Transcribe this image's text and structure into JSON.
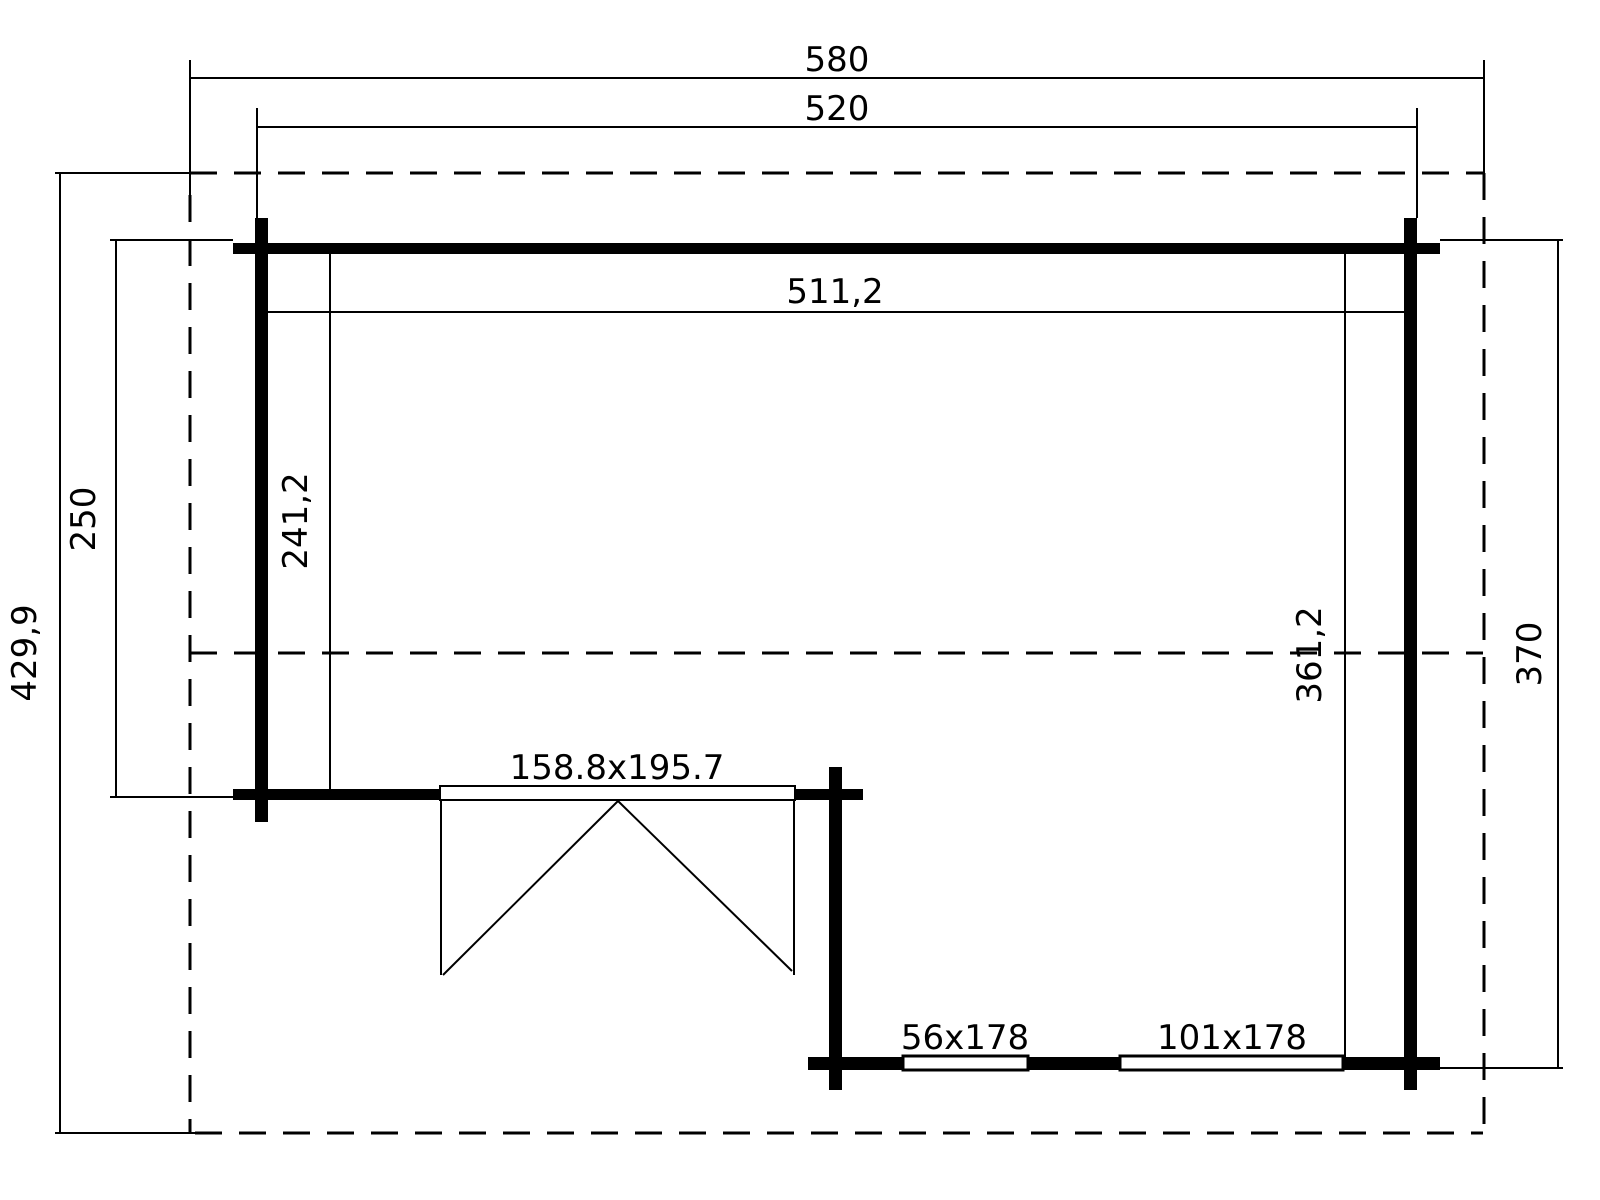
{
  "diagram": {
    "type": "floor-plan",
    "canvas": {
      "width": 1600,
      "height": 1200,
      "background": "#ffffff",
      "line_color": "#000000"
    },
    "labels": [
      {
        "name": "dim-label-roof-width",
        "text": "580",
        "x": 837,
        "y": 71,
        "rotate": 0
      },
      {
        "name": "dim-label-outer-width",
        "text": "520",
        "x": 837,
        "y": 120,
        "rotate": 0
      },
      {
        "name": "dim-label-inner-width",
        "text": "511,2",
        "x": 835,
        "y": 303,
        "rotate": 0
      },
      {
        "name": "dim-label-roof-depth",
        "text": "429,9",
        "x": 36,
        "y": 653,
        "rotate": -90
      },
      {
        "name": "dim-label-left-wall-depth",
        "text": "250",
        "x": 95,
        "y": 519,
        "rotate": -90
      },
      {
        "name": "dim-label-inner-depth-left",
        "text": "241,2",
        "x": 307,
        "y": 521,
        "rotate": -90
      },
      {
        "name": "dim-label-inner-depth-right",
        "text": "361,2",
        "x": 1321,
        "y": 655,
        "rotate": -90
      },
      {
        "name": "dim-label-right-wall-depth",
        "text": "370",
        "x": 1541,
        "y": 654,
        "rotate": -90
      },
      {
        "name": "door-size-label",
        "text": "158.8x195.7",
        "x": 617,
        "y": 779,
        "rotate": 0
      },
      {
        "name": "window-small-label",
        "text": "56x178",
        "x": 965,
        "y": 1049,
        "rotate": 0
      },
      {
        "name": "window-large-label",
        "text": "101x178",
        "x": 1232,
        "y": 1049,
        "rotate": 0
      }
    ],
    "walls": [
      {
        "name": "wall-top",
        "x": 233,
        "y": 243,
        "w": 1207,
        "h": 11
      },
      {
        "name": "wall-left",
        "x": 255,
        "y": 218,
        "w": 13,
        "h": 604
      },
      {
        "name": "wall-right",
        "x": 1404,
        "y": 218,
        "w": 13,
        "h": 872
      },
      {
        "name": "wall-door-left",
        "x": 233,
        "y": 789,
        "w": 210,
        "h": 11
      },
      {
        "name": "wall-door-right",
        "x": 790,
        "y": 789,
        "w": 73,
        "h": 11
      },
      {
        "name": "wall-mid-post",
        "x": 829,
        "y": 767,
        "w": 13,
        "h": 323
      },
      {
        "name": "wall-bottom-left-stub",
        "x": 808,
        "y": 1057,
        "w": 97,
        "h": 13
      },
      {
        "name": "wall-bottom-mid",
        "x": 1026,
        "y": 1057,
        "w": 96,
        "h": 13
      },
      {
        "name": "wall-bottom-right",
        "x": 1341,
        "y": 1057,
        "w": 99,
        "h": 13
      }
    ],
    "openings": [
      {
        "name": "door-frame",
        "x": 440,
        "y": 786,
        "w": 355,
        "h": 14,
        "stroke_w": 2
      },
      {
        "name": "window-small",
        "x": 903,
        "y": 1056,
        "w": 125,
        "h": 14,
        "stroke_w": 3
      },
      {
        "name": "window-large",
        "x": 1120,
        "y": 1056,
        "w": 223,
        "h": 14,
        "stroke_w": 3
      }
    ],
    "thin_lines": [
      {
        "name": "dim-line-580",
        "x1": 190,
        "y1": 78,
        "x2": 1485,
        "y2": 78
      },
      {
        "name": "dim-line-520",
        "x1": 257,
        "y1": 127,
        "x2": 1417,
        "y2": 127
      },
      {
        "name": "dim-line-511",
        "x1": 267,
        "y1": 312,
        "x2": 1404,
        "y2": 312
      },
      {
        "name": "dim-line-429",
        "x1": 60,
        "y1": 173,
        "x2": 60,
        "y2": 1133
      },
      {
        "name": "dim-line-250",
        "x1": 116,
        "y1": 240,
        "x2": 116,
        "y2": 798
      },
      {
        "name": "dim-line-241",
        "x1": 330,
        "y1": 254,
        "x2": 330,
        "y2": 790
      },
      {
        "name": "dim-line-361",
        "x1": 1345,
        "y1": 254,
        "x2": 1345,
        "y2": 1057
      },
      {
        "name": "dim-line-370",
        "x1": 1558,
        "y1": 240,
        "x2": 1558,
        "y2": 1068
      },
      {
        "name": "ext-line-580-left",
        "x1": 190,
        "y1": 60,
        "x2": 190,
        "y2": 195
      },
      {
        "name": "ext-line-580-right",
        "x1": 1484,
        "y1": 60,
        "x2": 1484,
        "y2": 173
      },
      {
        "name": "ext-line-520-left",
        "x1": 257,
        "y1": 108,
        "x2": 257,
        "y2": 243
      },
      {
        "name": "ext-line-520-right",
        "x1": 1417,
        "y1": 108,
        "x2": 1417,
        "y2": 218
      },
      {
        "name": "ext-line-429-top",
        "x1": 55,
        "y1": 173,
        "x2": 190,
        "y2": 173
      },
      {
        "name": "ext-line-429-bottom",
        "x1": 55,
        "y1": 1133,
        "x2": 195,
        "y2": 1133
      },
      {
        "name": "ext-line-250-top",
        "x1": 110,
        "y1": 240,
        "x2": 233,
        "y2": 240
      },
      {
        "name": "ext-line-250-bottom",
        "x1": 110,
        "y1": 797,
        "x2": 233,
        "y2": 797
      },
      {
        "name": "ext-line-370-top",
        "x1": 1440,
        "y1": 240,
        "x2": 1563,
        "y2": 240
      },
      {
        "name": "ext-line-370-bottom",
        "x1": 1440,
        "y1": 1068,
        "x2": 1563,
        "y2": 1068
      },
      {
        "name": "door-leaf-left-edge",
        "x1": 441,
        "y1": 800,
        "x2": 441,
        "y2": 975
      },
      {
        "name": "door-leaf-left-swing",
        "x1": 618,
        "y1": 801,
        "x2": 443,
        "y2": 975
      },
      {
        "name": "door-leaf-right-edge",
        "x1": 794,
        "y1": 800,
        "x2": 794,
        "y2": 975
      },
      {
        "name": "door-leaf-right-swing",
        "x1": 618,
        "y1": 801,
        "x2": 792,
        "y2": 971
      }
    ],
    "dashed_lines": [
      {
        "name": "roof-outline-top",
        "x1": 190,
        "y1": 173,
        "x2": 1483,
        "y2": 173
      },
      {
        "name": "roof-outline-bottom",
        "x1": 195,
        "y1": 1133,
        "x2": 1483,
        "y2": 1133
      },
      {
        "name": "roof-outline-left",
        "x1": 190,
        "y1": 195,
        "x2": 190,
        "y2": 1133
      },
      {
        "name": "roof-outline-right",
        "x1": 1484,
        "y1": 173,
        "x2": 1484,
        "y2": 1133
      },
      {
        "name": "roof-ridge-line",
        "x1": 190,
        "y1": 653,
        "x2": 1483,
        "y2": 653
      }
    ]
  }
}
